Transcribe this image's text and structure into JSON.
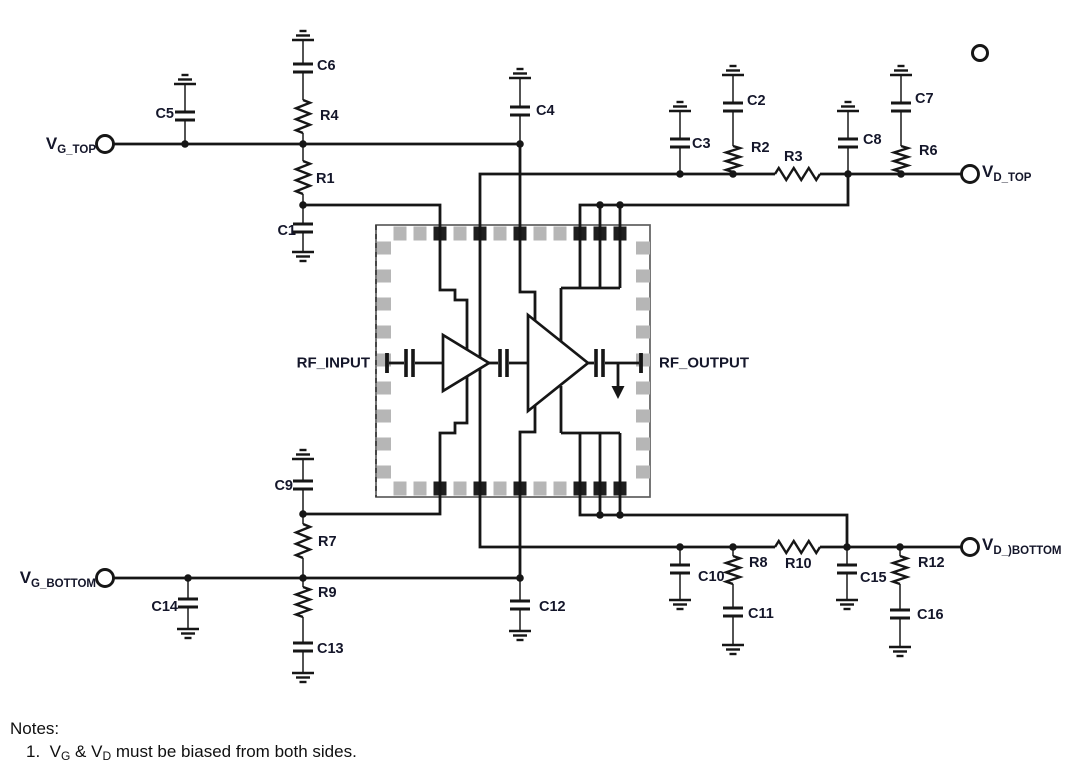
{
  "schematic": {
    "notes": {
      "title": "Notes:",
      "item_parts": [
        {
          "t": "1.  V"
        },
        {
          "sub": "G"
        },
        {
          "t": " & V"
        },
        {
          "sub": "D"
        },
        {
          "t": " must be biased from both sides."
        }
      ]
    },
    "terminal_labels": [
      {
        "id": "vg-top",
        "main": "V",
        "sub": "G_TOP",
        "x": 96,
        "y": 144,
        "align": "right"
      },
      {
        "id": "vd-top",
        "main": "V",
        "sub": "D_TOP",
        "x": 982,
        "y": 172,
        "align": "left"
      },
      {
        "id": "vg-bottom",
        "main": "V",
        "sub": "G_BOTTOM",
        "x": 96,
        "y": 578,
        "align": "right"
      },
      {
        "id": "vd-bottom",
        "main": "V",
        "sub": "D_)BOTTOM",
        "x": 982,
        "y": 545,
        "align": "left"
      }
    ],
    "rf_labels": [
      {
        "id": "rf-input",
        "text": "RF_INPUT",
        "x": 370,
        "y": 363,
        "align": "right"
      },
      {
        "id": "rf-output",
        "text": "RF_OUTPUT",
        "x": 659,
        "y": 363,
        "align": "left"
      }
    ],
    "component_labels": [
      {
        "text": "C1",
        "x": 296,
        "y": 231,
        "align": "right"
      },
      {
        "text": "C2",
        "x": 747,
        "y": 101,
        "align": "left"
      },
      {
        "text": "C3",
        "x": 692,
        "y": 144,
        "align": "left"
      },
      {
        "text": "C4",
        "x": 536,
        "y": 111,
        "align": "left"
      },
      {
        "text": "C5",
        "x": 174,
        "y": 114,
        "align": "right"
      },
      {
        "text": "C6",
        "x": 317,
        "y": 66,
        "align": "left"
      },
      {
        "text": "C7",
        "x": 915,
        "y": 99,
        "align": "left"
      },
      {
        "text": "C8",
        "x": 863,
        "y": 140,
        "align": "left"
      },
      {
        "text": "C9",
        "x": 293,
        "y": 486,
        "align": "right"
      },
      {
        "text": "C10",
        "x": 698,
        "y": 577,
        "align": "left"
      },
      {
        "text": "C11",
        "x": 748,
        "y": 614,
        "align": "left"
      },
      {
        "text": "C12",
        "x": 539,
        "y": 607,
        "align": "left"
      },
      {
        "text": "C13",
        "x": 317,
        "y": 649,
        "align": "left"
      },
      {
        "text": "C14",
        "x": 178,
        "y": 607,
        "align": "right"
      },
      {
        "text": "C15",
        "x": 860,
        "y": 578,
        "align": "left"
      },
      {
        "text": "C16",
        "x": 917,
        "y": 615,
        "align": "left"
      },
      {
        "text": "R1",
        "x": 316,
        "y": 179,
        "align": "left"
      },
      {
        "text": "R2",
        "x": 751,
        "y": 148,
        "align": "left"
      },
      {
        "text": "R3",
        "x": 784,
        "y": 157,
        "align": "left"
      },
      {
        "text": "R4",
        "x": 320,
        "y": 116,
        "align": "left"
      },
      {
        "text": "R6",
        "x": 919,
        "y": 151,
        "align": "left"
      },
      {
        "text": "R7",
        "x": 318,
        "y": 542,
        "align": "left"
      },
      {
        "text": "R8",
        "x": 749,
        "y": 563,
        "align": "left"
      },
      {
        "text": "R9",
        "x": 318,
        "y": 593,
        "align": "left"
      },
      {
        "text": "R10",
        "x": 785,
        "y": 564,
        "align": "left"
      },
      {
        "text": "R12",
        "x": 918,
        "y": 563,
        "align": "left"
      }
    ],
    "colors": {
      "wire": "#161616",
      "stem": "#4a4a4a",
      "pad": "#b6b6b6",
      "pad_dark": "#1e1e1e",
      "outline": "#5f5f5f",
      "label": "#14162a",
      "notes": "#101010",
      "background": "#ffffff"
    }
  }
}
